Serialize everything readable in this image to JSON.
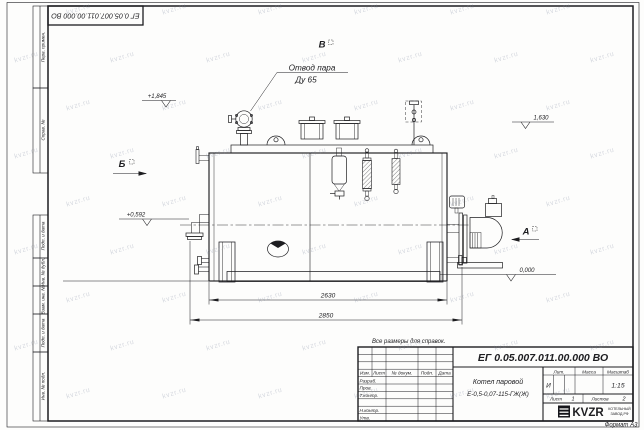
{
  "sheet": {
    "stamp_top": "ЕГ 0.05.007.011.00.000 ВО",
    "note": "Все размеры для справок.",
    "format": "Формат А3"
  },
  "watermark": {
    "text": "kvzr.ru"
  },
  "frame_strip": {
    "cells": [
      "Перв. примен.",
      "Справ. №",
      "Подп. и дата",
      "Инв. № дубл.",
      "Взам. инв. №",
      "Подп. и дата",
      "Инв. № подл."
    ]
  },
  "drawing": {
    "callout": {
      "line1": "Отвод пара",
      "line2": "Ду 65"
    },
    "views": {
      "a": "А",
      "b": "Б",
      "v": "В"
    },
    "elevations": {
      "valve_top": "+1,845",
      "right_top": "1,630",
      "burner_axis": "+0,592",
      "ground": "0,000"
    },
    "dimensions": {
      "shell_length": "2630",
      "overall_length": "2850"
    }
  },
  "title_block": {
    "doc_number": "ЕГ 0.05.007.011.00.000 ВО",
    "product_line1": "Котел паровой",
    "product_line2": "Е-0,5-0,07-115-ГЖ(Ж)",
    "columns": {
      "izm": "Изм.",
      "list": "Лист",
      "doc": "№ докум.",
      "sign": "Подп.",
      "date": "Дата"
    },
    "rows": {
      "developed": "Разраб.",
      "checked": "Пров.",
      "tcontrol": "Т.контр.",
      "ncontrol": "Н.контр.",
      "approved": "Утв."
    },
    "lit_header": "Лит.",
    "lit_value": "И",
    "mass_header": "Масса",
    "scale_header": "Масштаб",
    "scale_value": "1:15",
    "sheet_label": "Лист",
    "sheet_value": "1",
    "sheets_label": "Листов",
    "sheets_value": "2",
    "org": {
      "logo": "KVZR",
      "line1": "КОТЕЛЬНЫЙ",
      "line2": "ЗАВОД.РФ"
    }
  }
}
